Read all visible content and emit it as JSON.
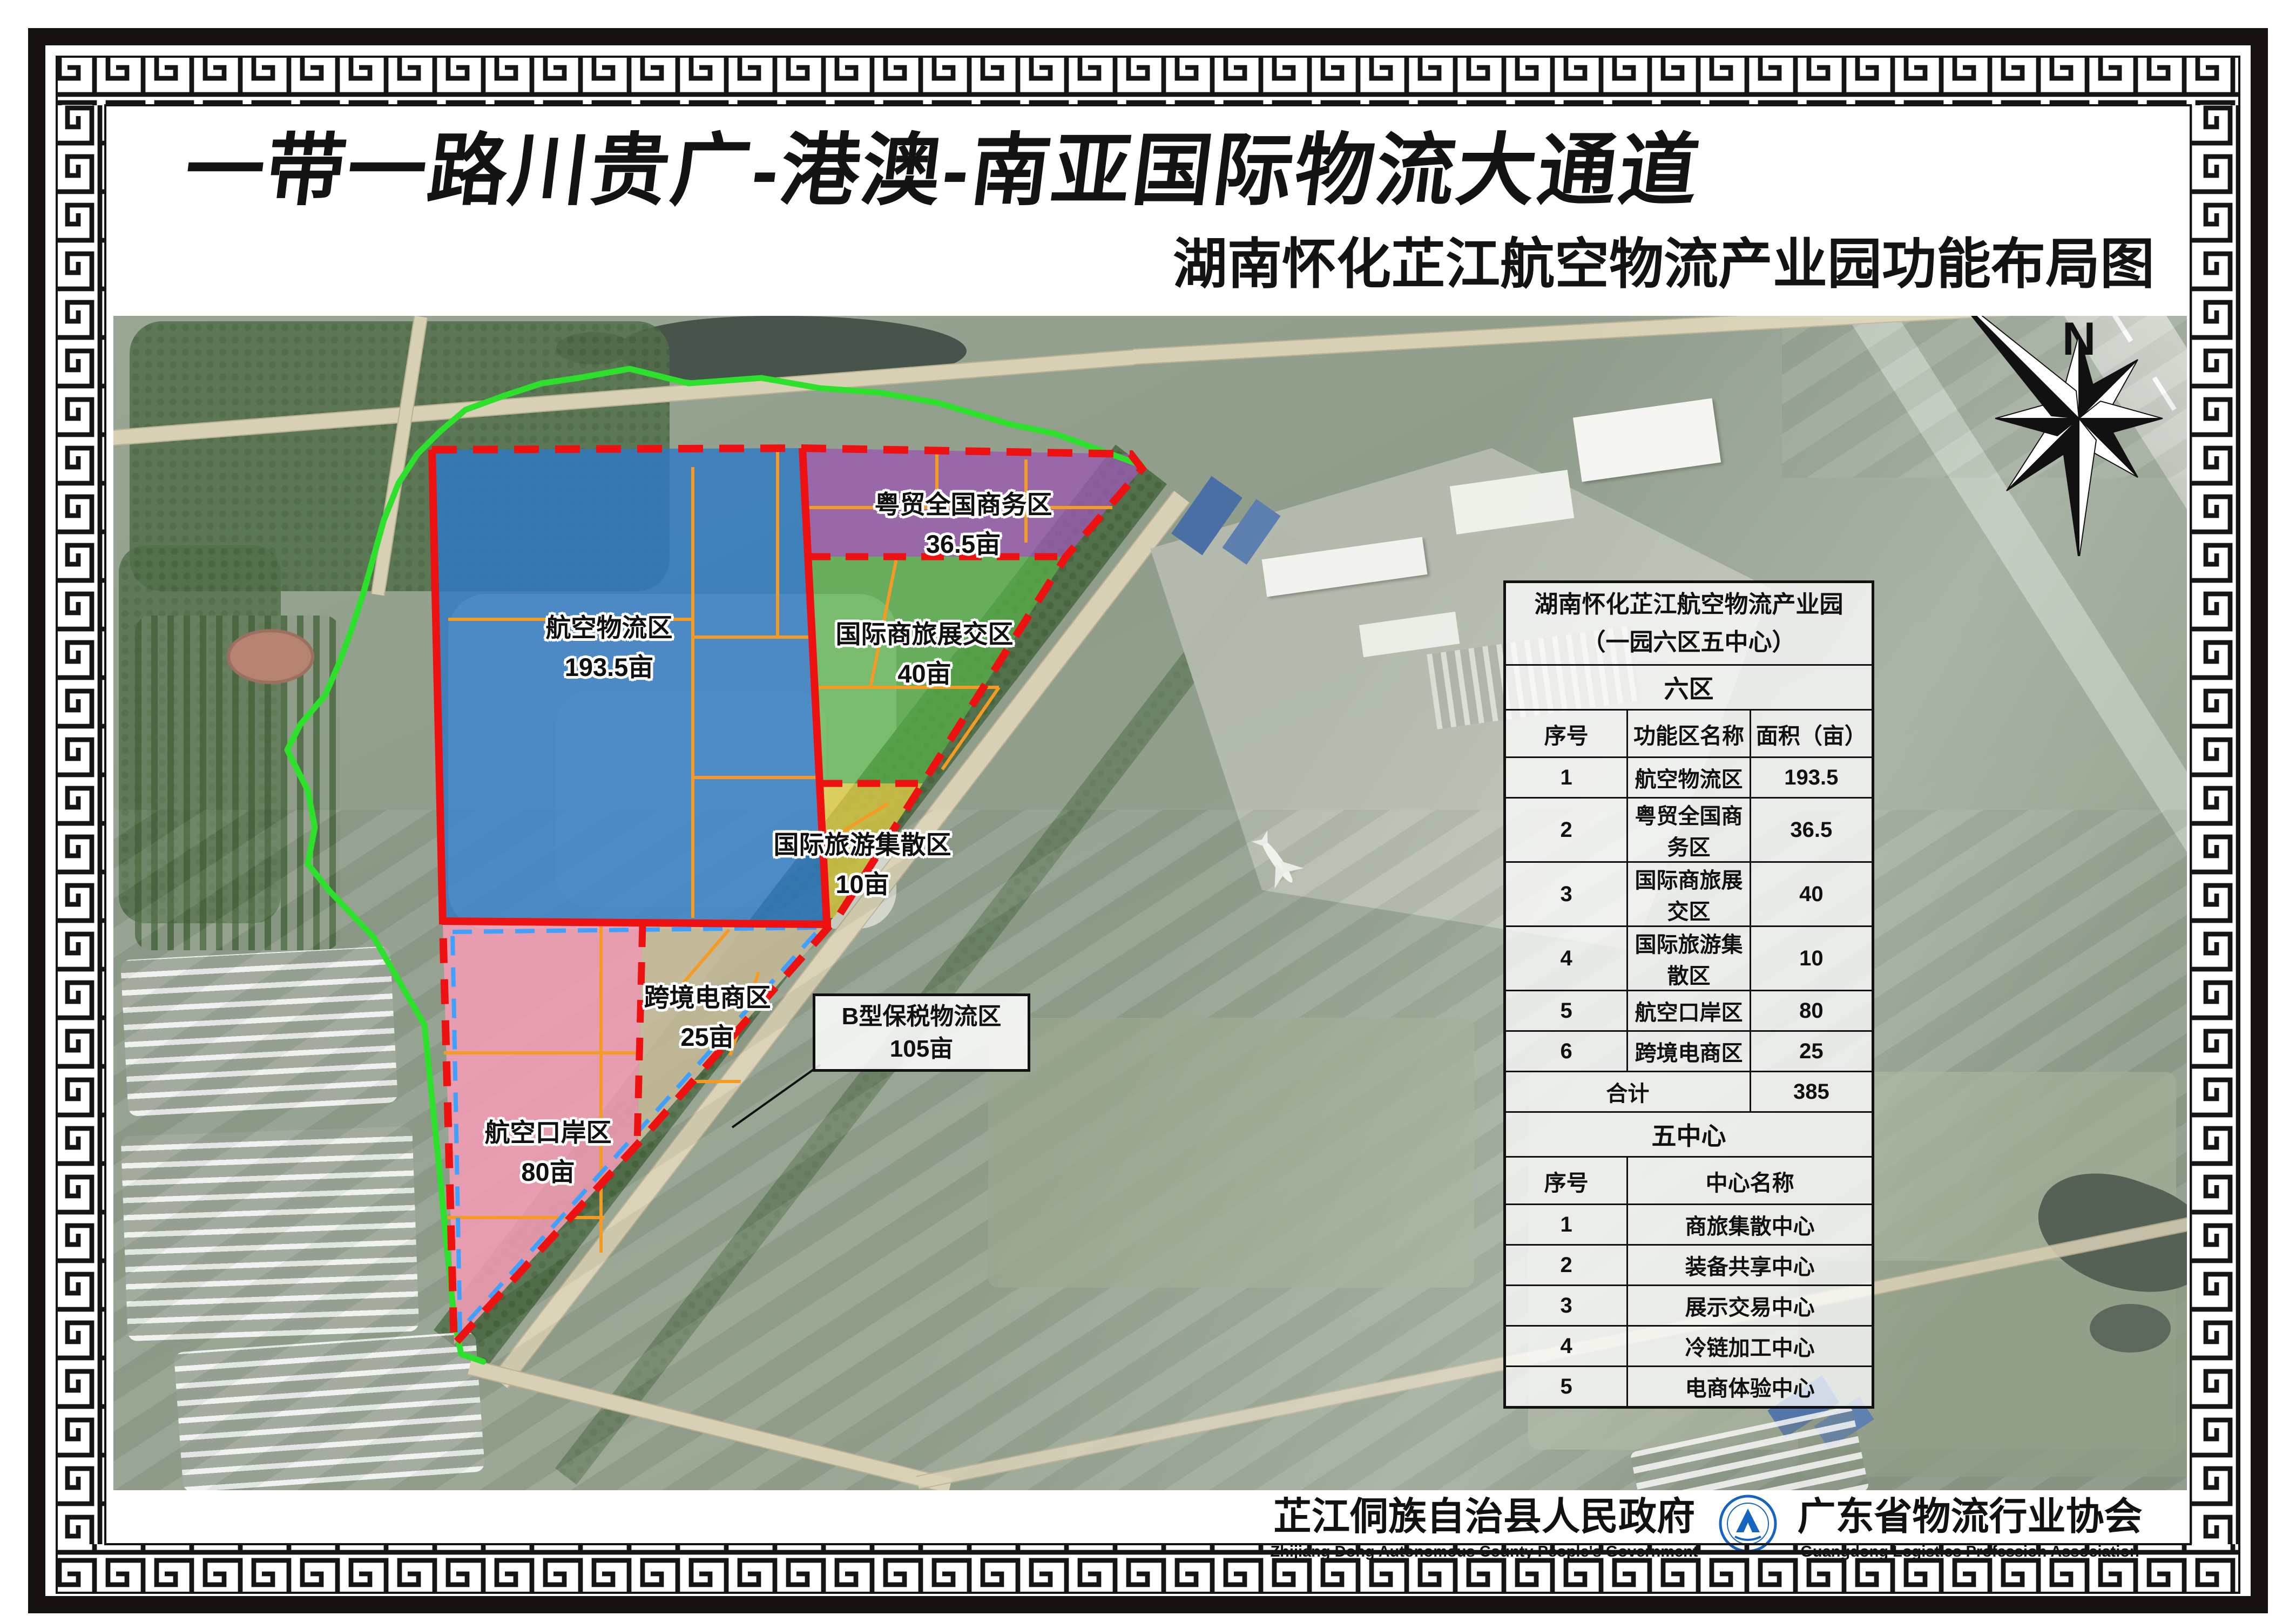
{
  "titles": {
    "main": "一带一路川贵广-港澳-南亚国际物流大通道",
    "sub": "湖南怀化芷江航空物流产业园功能布局图"
  },
  "compass": {
    "north": "N"
  },
  "zones": {
    "aviation_logistics": {
      "label": "航空物流区",
      "area": "193.5亩",
      "color": "#2e79c4"
    },
    "yuemao_business": {
      "label": "粤贸全国商务区",
      "area": "36.5亩",
      "color": "#9a5ab0"
    },
    "intl_expo": {
      "label": "国际商旅展交区",
      "area": "40亩",
      "color": "#57b34a"
    },
    "intl_tourism": {
      "label": "国际旅游集散区",
      "area": "10亩",
      "color": "#ddca45"
    },
    "aviation_port": {
      "label": "航空口岸区",
      "area": "80亩",
      "color": "#f29cb4"
    },
    "cross_border": {
      "label": "跨境电商区",
      "area": "25亩",
      "color": "#c9bc9c"
    },
    "bonded": {
      "label": "B型保税物流区",
      "area": "105亩"
    }
  },
  "boundary_colors": {
    "park_outline": "#2ce02c",
    "red_dashed": "#ee1111",
    "blue_dashed": "#3fa0ff",
    "orange_parcel": "#f59a23"
  },
  "info_table": {
    "title": "湖南怀化芷江航空物流产业园",
    "subtitle": "（一园六区五中心）",
    "section1": "六区",
    "headers1": [
      "序号",
      "功能区名称",
      "面积（亩）"
    ],
    "rows1": [
      [
        "1",
        "航空物流区",
        "193.5"
      ],
      [
        "2",
        "粤贸全国商务区",
        "36.5"
      ],
      [
        "3",
        "国际商旅展交区",
        "40"
      ],
      [
        "4",
        "国际旅游集散区",
        "10"
      ],
      [
        "5",
        "航空口岸区",
        "80"
      ],
      [
        "6",
        "跨境电商区",
        "25"
      ]
    ],
    "total_label": "合计",
    "total_value": "385",
    "section2": "五中心",
    "headers2": [
      "序号",
      "中心名称"
    ],
    "rows2": [
      [
        "1",
        "商旅集散中心"
      ],
      [
        "2",
        "装备共享中心"
      ],
      [
        "3",
        "展示交易中心"
      ],
      [
        "4",
        "冷链加工中心"
      ],
      [
        "5",
        "电商体验中心"
      ]
    ]
  },
  "footer": {
    "org1": {
      "name": "芷江侗族自治县人民政府",
      "en": "Zhijiang Dong Autonomous County People's Government"
    },
    "org2": {
      "name": "广东省物流行业协会",
      "en": "Guangdong Logistics Profession Association"
    }
  }
}
